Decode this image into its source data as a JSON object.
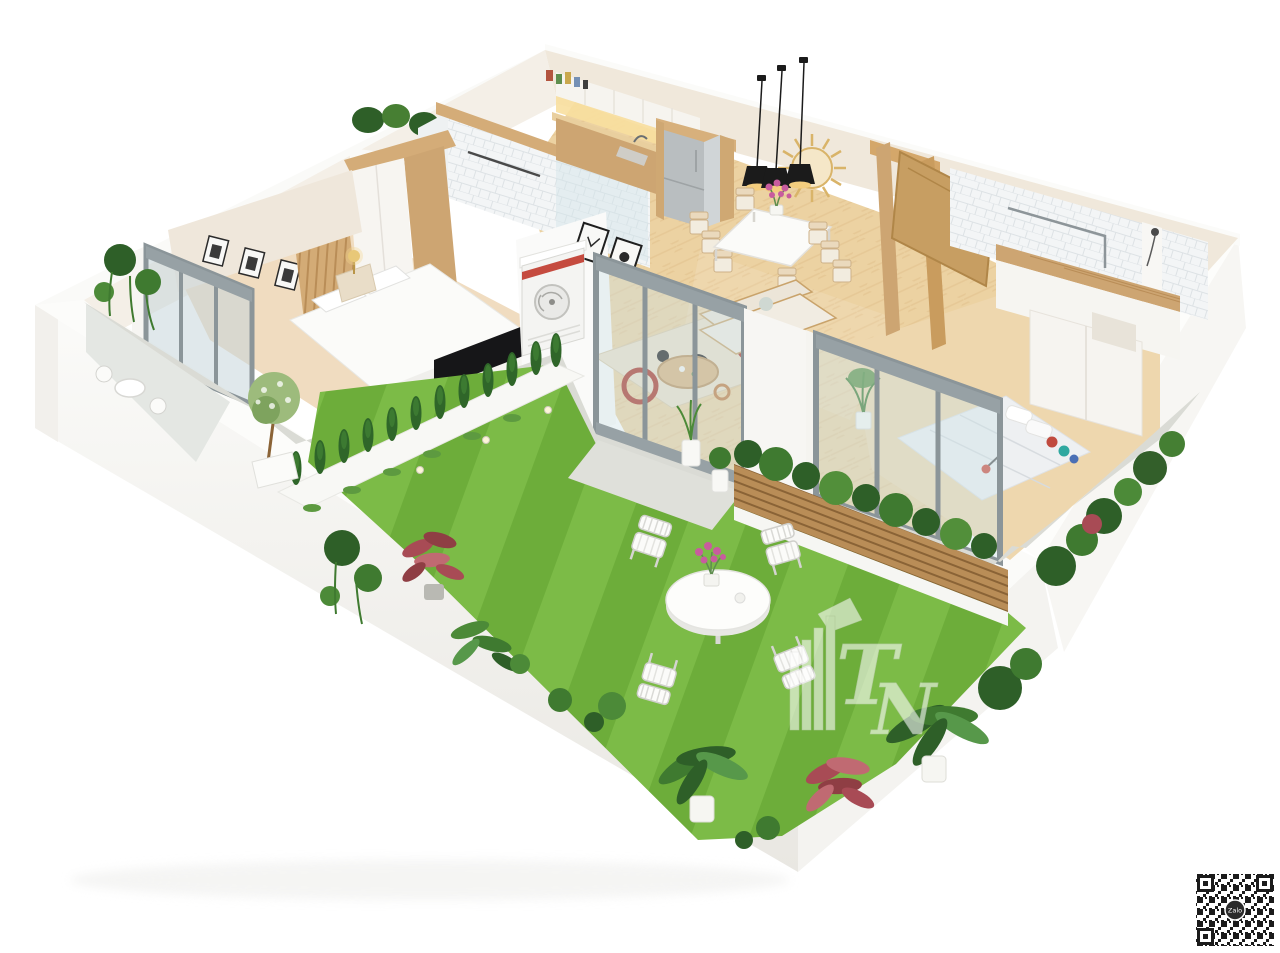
{
  "scene": {
    "title": "3D apartment floor plan render with garden",
    "watermark": {
      "letter_t": "T",
      "letter_n": "N"
    },
    "qr": {
      "label": "Zalo"
    }
  },
  "colors": {
    "background": "#ffffff",
    "wall_white": "#f7f6f3",
    "wall_rim": "#fcfcfa",
    "wall_cream": "#f0e8db",
    "wall_cream_light": "#f4efe7",
    "wood": "#cda572",
    "wood_dark": "#b98d57",
    "wood_cap": "#d4ac78",
    "floor_wood": "#ecd2a2",
    "floor_bedroom": "#f0dcc0",
    "tile_base": "#f3f5f6",
    "tile_line": "#dde2e5",
    "glass": "#cfe3e6",
    "frame_gray": "#8b9599",
    "grass_light": "#7cbb47",
    "grass_dark": "#6dad3a",
    "foliage_dark": "#2e5f28",
    "foliage_mid": "#3f7a30",
    "foliage_light": "#57984a",
    "plant_red": "#a84b55",
    "plant_pink": "#c06a72",
    "paving": "#dadbd5",
    "patio": "#e4e7e3",
    "accent_red": "#c0392b",
    "gold": "#d9b469",
    "black": "#1b1b1b",
    "flower_pink": "#c85c9e",
    "fridge_gray": "#b9bec0",
    "rug_base": "#ecdfc8"
  }
}
